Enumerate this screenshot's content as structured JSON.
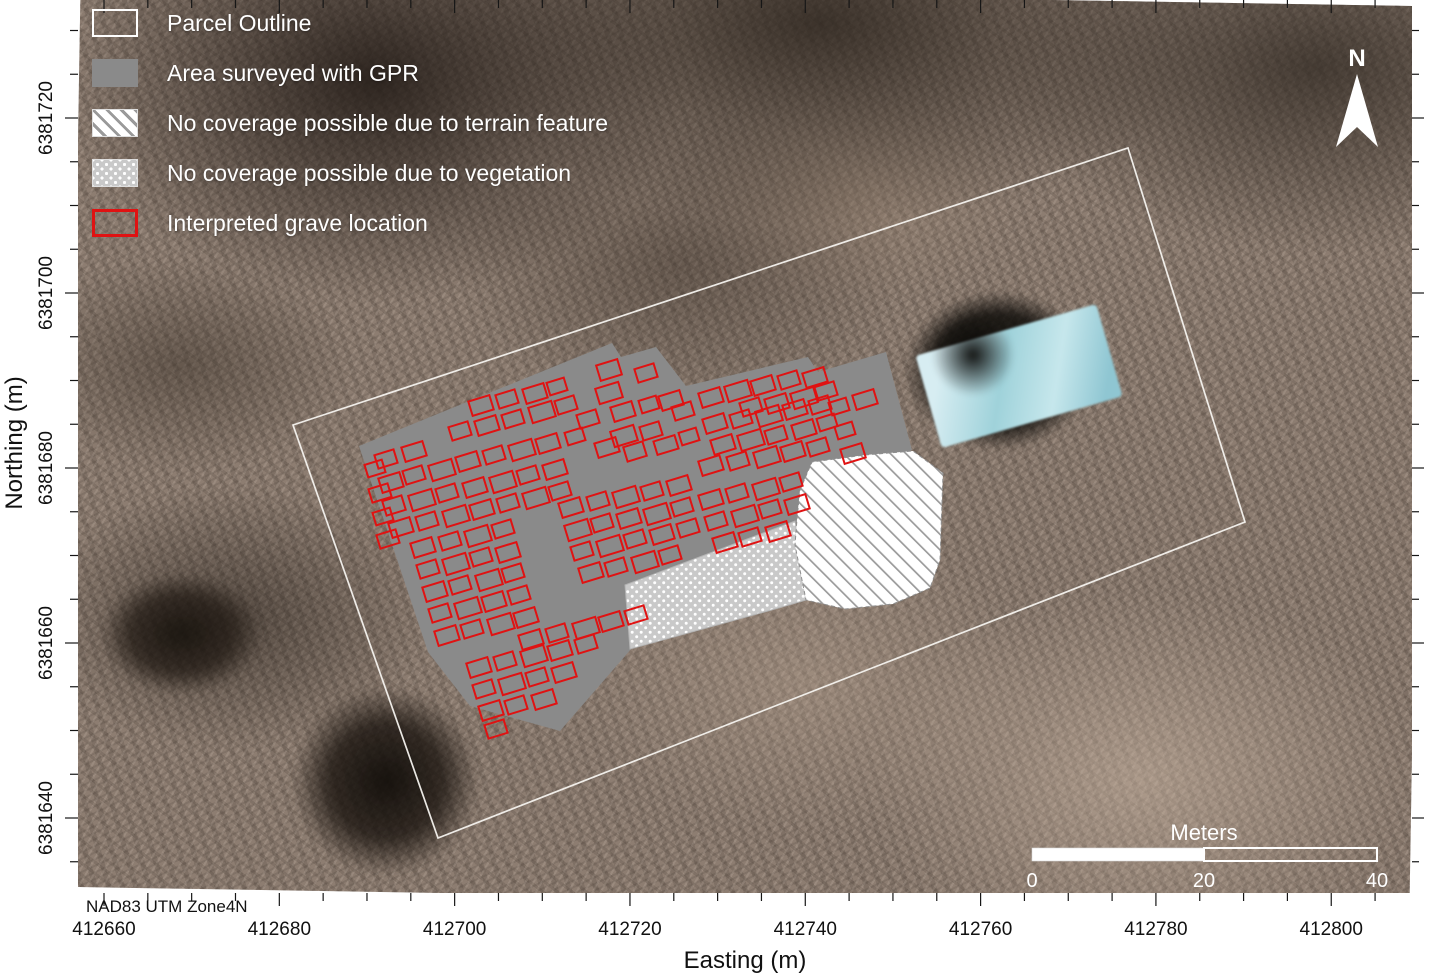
{
  "datum_note": "NAD83 UTM Zone4N",
  "north_arrow": {
    "label": "N"
  },
  "colors": {
    "gpr_gray": "#8a8a8a",
    "grave_red": "#e01212",
    "parcel_white": "#f5f3ef",
    "hatch_line_gray": "#9a9a9a",
    "vegetation_gray": "#c9c9c9",
    "tick_black": "#161616",
    "building_roof_teal": "#9fd2da"
  },
  "legend": {
    "items": [
      {
        "type": "parcel",
        "label": "Parcel Outline"
      },
      {
        "type": "gpr",
        "label": "Area surveyed with GPR"
      },
      {
        "type": "terrain",
        "label": "No coverage possible due to terrain feature"
      },
      {
        "type": "vegetation",
        "label": "No coverage possible due to vegetation"
      },
      {
        "type": "grave",
        "label": "Interpreted grave location"
      }
    ]
  },
  "map_frame": {
    "x": 78,
    "y": 0,
    "w": 1334,
    "h": 893
  },
  "axes": {
    "x": {
      "label": "Easting (m)",
      "tick_values": [
        412660,
        412680,
        412700,
        412720,
        412740,
        412760,
        412780,
        412800
      ],
      "range": [
        412660,
        412805
      ],
      "origin_value": 412660,
      "origin_px": 104,
      "px_per_m": 8.766,
      "minor_step": 5,
      "major_step": 20,
      "label_y": 935
    },
    "y": {
      "label": "Northing (m)",
      "tick_values": [
        6381720,
        6381700,
        6381680,
        6381660,
        6381640
      ],
      "range": [
        6381635,
        6381730
      ],
      "origin_value": 6381640,
      "origin_px": 818,
      "px_per_m": 8.75,
      "minor_step": 5,
      "major_step": 20,
      "label_x": 52
    }
  },
  "scalebar": {
    "title": "Meters",
    "x0": 1032,
    "mid": 1204,
    "x1": 1377,
    "y": 848,
    "h": 13,
    "label_y": 887,
    "ticks": [
      {
        "label": "0",
        "px": 1032
      },
      {
        "label": "20",
        "px": 1204
      },
      {
        "label": "40",
        "px": 1377
      }
    ]
  },
  "map_layers": {
    "parcel_outline": {
      "points": [
        [
          293,
          425
        ],
        [
          1128,
          148
        ],
        [
          1245,
          522
        ],
        [
          438,
          838
        ]
      ]
    },
    "gpr_area": {
      "points": [
        [
          359,
          446
        ],
        [
          612,
          343
        ],
        [
          621,
          357
        ],
        [
          656,
          347
        ],
        [
          686,
          386
        ],
        [
          808,
          357
        ],
        [
          818,
          372
        ],
        [
          886,
          352
        ],
        [
          912,
          450
        ],
        [
          800,
          492
        ],
        [
          797,
          522
        ],
        [
          628,
          585
        ],
        [
          632,
          648
        ],
        [
          560,
          731
        ],
        [
          470,
          706
        ],
        [
          428,
          652
        ]
      ]
    },
    "terrain_no_coverage": {
      "points": [
        [
          800,
          490
        ],
        [
          812,
          462
        ],
        [
          865,
          455
        ],
        [
          913,
          451
        ],
        [
          943,
          473
        ],
        [
          940,
          560
        ],
        [
          930,
          588
        ],
        [
          893,
          604
        ],
        [
          845,
          609
        ],
        [
          806,
          600
        ],
        [
          795,
          545
        ],
        [
          797,
          519
        ]
      ]
    },
    "vegetation_no_coverage": {
      "points": [
        [
          625,
          585
        ],
        [
          795,
          521
        ],
        [
          800,
          548
        ],
        [
          806,
          600
        ],
        [
          768,
          611
        ],
        [
          630,
          649
        ]
      ]
    },
    "graves": {
      "rotation_deg": -17,
      "rects": [
        [
          598,
          362,
          22,
          16
        ],
        [
          636,
          366,
          20,
          14
        ],
        [
          597,
          385,
          24,
          16
        ],
        [
          612,
          404,
          22,
          15
        ],
        [
          578,
          412,
          20,
          14
        ],
        [
          640,
          398,
          18,
          13
        ],
        [
          660,
          393,
          22,
          15
        ],
        [
          673,
          404,
          20,
          14
        ],
        [
          612,
          428,
          24,
          16
        ],
        [
          641,
          424,
          20,
          14
        ],
        [
          596,
          440,
          22,
          15
        ],
        [
          625,
          444,
          20,
          15
        ],
        [
          655,
          438,
          22,
          14
        ],
        [
          680,
          430,
          18,
          13
        ],
        [
          566,
          430,
          18,
          13
        ],
        [
          700,
          390,
          22,
          15
        ],
        [
          726,
          383,
          24,
          16
        ],
        [
          752,
          378,
          22,
          15
        ],
        [
          779,
          373,
          20,
          14
        ],
        [
          804,
          370,
          22,
          15
        ],
        [
          741,
          400,
          20,
          14
        ],
        [
          766,
          396,
          22,
          15
        ],
        [
          792,
          390,
          24,
          16
        ],
        [
          816,
          384,
          20,
          14
        ],
        [
          704,
          416,
          22,
          15
        ],
        [
          731,
          412,
          20,
          14
        ],
        [
          757,
          408,
          24,
          16
        ],
        [
          784,
          402,
          22,
          15
        ],
        [
          810,
          398,
          20,
          14
        ],
        [
          712,
          437,
          22,
          15
        ],
        [
          739,
          432,
          24,
          16
        ],
        [
          766,
          428,
          20,
          14
        ],
        [
          793,
          422,
          22,
          15
        ],
        [
          818,
          416,
          18,
          13
        ],
        [
          700,
          458,
          22,
          15
        ],
        [
          728,
          454,
          20,
          14
        ],
        [
          755,
          449,
          24,
          16
        ],
        [
          782,
          444,
          22,
          15
        ],
        [
          808,
          440,
          20,
          14
        ],
        [
          376,
          452,
          20,
          14
        ],
        [
          403,
          444,
          22,
          15
        ],
        [
          380,
          475,
          22,
          15
        ],
        [
          404,
          468,
          20,
          14
        ],
        [
          430,
          462,
          24,
          16
        ],
        [
          457,
          454,
          22,
          15
        ],
        [
          484,
          448,
          20,
          14
        ],
        [
          510,
          442,
          24,
          16
        ],
        [
          537,
          436,
          22,
          15
        ],
        [
          384,
          498,
          20,
          15
        ],
        [
          410,
          492,
          24,
          16
        ],
        [
          437,
          486,
          20,
          14
        ],
        [
          464,
          480,
          22,
          15
        ],
        [
          491,
          474,
          24,
          16
        ],
        [
          518,
          468,
          20,
          14
        ],
        [
          544,
          462,
          22,
          15
        ],
        [
          390,
          520,
          22,
          15
        ],
        [
          417,
          514,
          20,
          14
        ],
        [
          444,
          508,
          24,
          16
        ],
        [
          471,
          502,
          22,
          15
        ],
        [
          498,
          496,
          20,
          14
        ],
        [
          524,
          490,
          24,
          16
        ],
        [
          550,
          484,
          20,
          14
        ],
        [
          560,
          500,
          22,
          15
        ],
        [
          588,
          494,
          20,
          14
        ],
        [
          614,
          489,
          24,
          16
        ],
        [
          642,
          484,
          20,
          14
        ],
        [
          668,
          478,
          22,
          15
        ],
        [
          566,
          522,
          24,
          16
        ],
        [
          592,
          516,
          20,
          14
        ],
        [
          618,
          511,
          22,
          15
        ],
        [
          645,
          506,
          24,
          16
        ],
        [
          672,
          500,
          20,
          14
        ],
        [
          572,
          544,
          20,
          14
        ],
        [
          598,
          538,
          24,
          16
        ],
        [
          625,
          532,
          20,
          14
        ],
        [
          651,
          527,
          22,
          15
        ],
        [
          678,
          521,
          20,
          14
        ],
        [
          580,
          565,
          22,
          15
        ],
        [
          606,
          560,
          20,
          14
        ],
        [
          633,
          554,
          24,
          16
        ],
        [
          660,
          548,
          20,
          14
        ],
        [
          412,
          540,
          22,
          15
        ],
        [
          440,
          534,
          20,
          14
        ],
        [
          466,
          528,
          24,
          16
        ],
        [
          493,
          522,
          20,
          14
        ],
        [
          418,
          562,
          20,
          14
        ],
        [
          444,
          556,
          24,
          16
        ],
        [
          471,
          550,
          20,
          14
        ],
        [
          497,
          545,
          22,
          15
        ],
        [
          424,
          584,
          22,
          15
        ],
        [
          450,
          578,
          20,
          14
        ],
        [
          477,
          572,
          24,
          16
        ],
        [
          503,
          566,
          20,
          14
        ],
        [
          430,
          606,
          20,
          14
        ],
        [
          456,
          600,
          24,
          16
        ],
        [
          483,
          594,
          22,
          15
        ],
        [
          509,
          588,
          20,
          14
        ],
        [
          436,
          628,
          22,
          15
        ],
        [
          462,
          622,
          20,
          14
        ],
        [
          489,
          616,
          24,
          16
        ],
        [
          515,
          610,
          22,
          15
        ],
        [
          520,
          632,
          22,
          15
        ],
        [
          547,
          626,
          20,
          14
        ],
        [
          574,
          620,
          24,
          16
        ],
        [
          600,
          614,
          22,
          15
        ],
        [
          626,
          608,
          20,
          14
        ],
        [
          468,
          660,
          22,
          15
        ],
        [
          495,
          654,
          20,
          14
        ],
        [
          522,
          648,
          24,
          16
        ],
        [
          549,
          643,
          22,
          15
        ],
        [
          576,
          637,
          20,
          14
        ],
        [
          474,
          682,
          20,
          14
        ],
        [
          500,
          676,
          24,
          16
        ],
        [
          527,
          670,
          20,
          14
        ],
        [
          553,
          665,
          22,
          15
        ],
        [
          480,
          703,
          22,
          15
        ],
        [
          506,
          698,
          20,
          14
        ],
        [
          533,
          692,
          22,
          15
        ],
        [
          486,
          722,
          20,
          14
        ],
        [
          700,
          492,
          22,
          15
        ],
        [
          727,
          486,
          20,
          14
        ],
        [
          754,
          481,
          24,
          16
        ],
        [
          781,
          475,
          20,
          14
        ],
        [
          706,
          514,
          20,
          14
        ],
        [
          733,
          508,
          24,
          16
        ],
        [
          760,
          502,
          20,
          14
        ],
        [
          786,
          497,
          22,
          15
        ],
        [
          714,
          535,
          22,
          15
        ],
        [
          740,
          530,
          20,
          14
        ],
        [
          767,
          524,
          22,
          15
        ],
        [
          366,
          462,
          18,
          13
        ],
        [
          370,
          486,
          20,
          14
        ],
        [
          374,
          510,
          18,
          13
        ],
        [
          378,
          532,
          20,
          14
        ],
        [
          450,
          424,
          20,
          14
        ],
        [
          476,
          418,
          22,
          15
        ],
        [
          503,
          412,
          20,
          14
        ],
        [
          530,
          404,
          24,
          16
        ],
        [
          556,
          398,
          20,
          14
        ],
        [
          470,
          398,
          22,
          15
        ],
        [
          497,
          392,
          20,
          14
        ],
        [
          524,
          386,
          22,
          15
        ],
        [
          548,
          380,
          18,
          13
        ],
        [
          842,
          446,
          22,
          15
        ],
        [
          854,
          392,
          22,
          15
        ],
        [
          830,
          400,
          18,
          13
        ],
        [
          836,
          424,
          18,
          13
        ]
      ]
    }
  }
}
